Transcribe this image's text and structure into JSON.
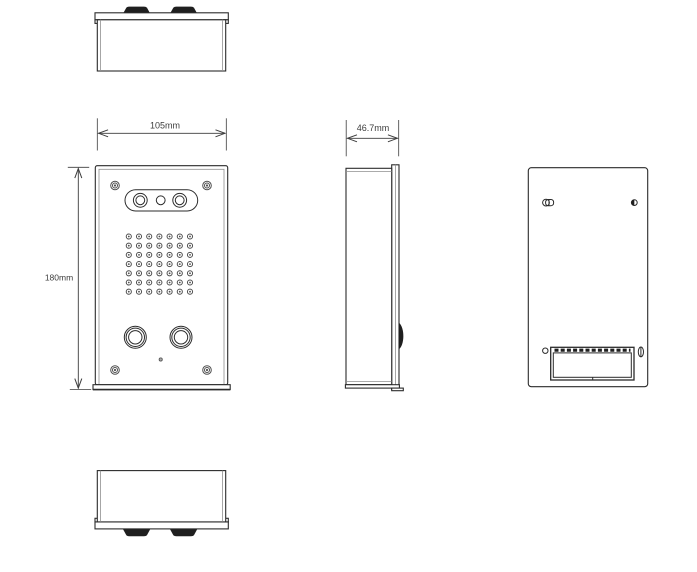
{
  "dimensions": {
    "front_width": "105mm",
    "side_depth": "46.7mm",
    "front_height": "180mm"
  },
  "speaker_grille": {
    "rows": 7,
    "cols": 7
  },
  "front_features": {
    "corner_screws": 4,
    "camera_lenses": 3,
    "call_buttons": 2,
    "microphone_holes": 1
  },
  "colors": {
    "background": "#ffffff",
    "line": "#2b2b2b",
    "line_light": "#8f8f8f",
    "dimension": "#3c3c3c",
    "dark_fill": "#1f1f1f",
    "screw": "#4f4f4f"
  }
}
